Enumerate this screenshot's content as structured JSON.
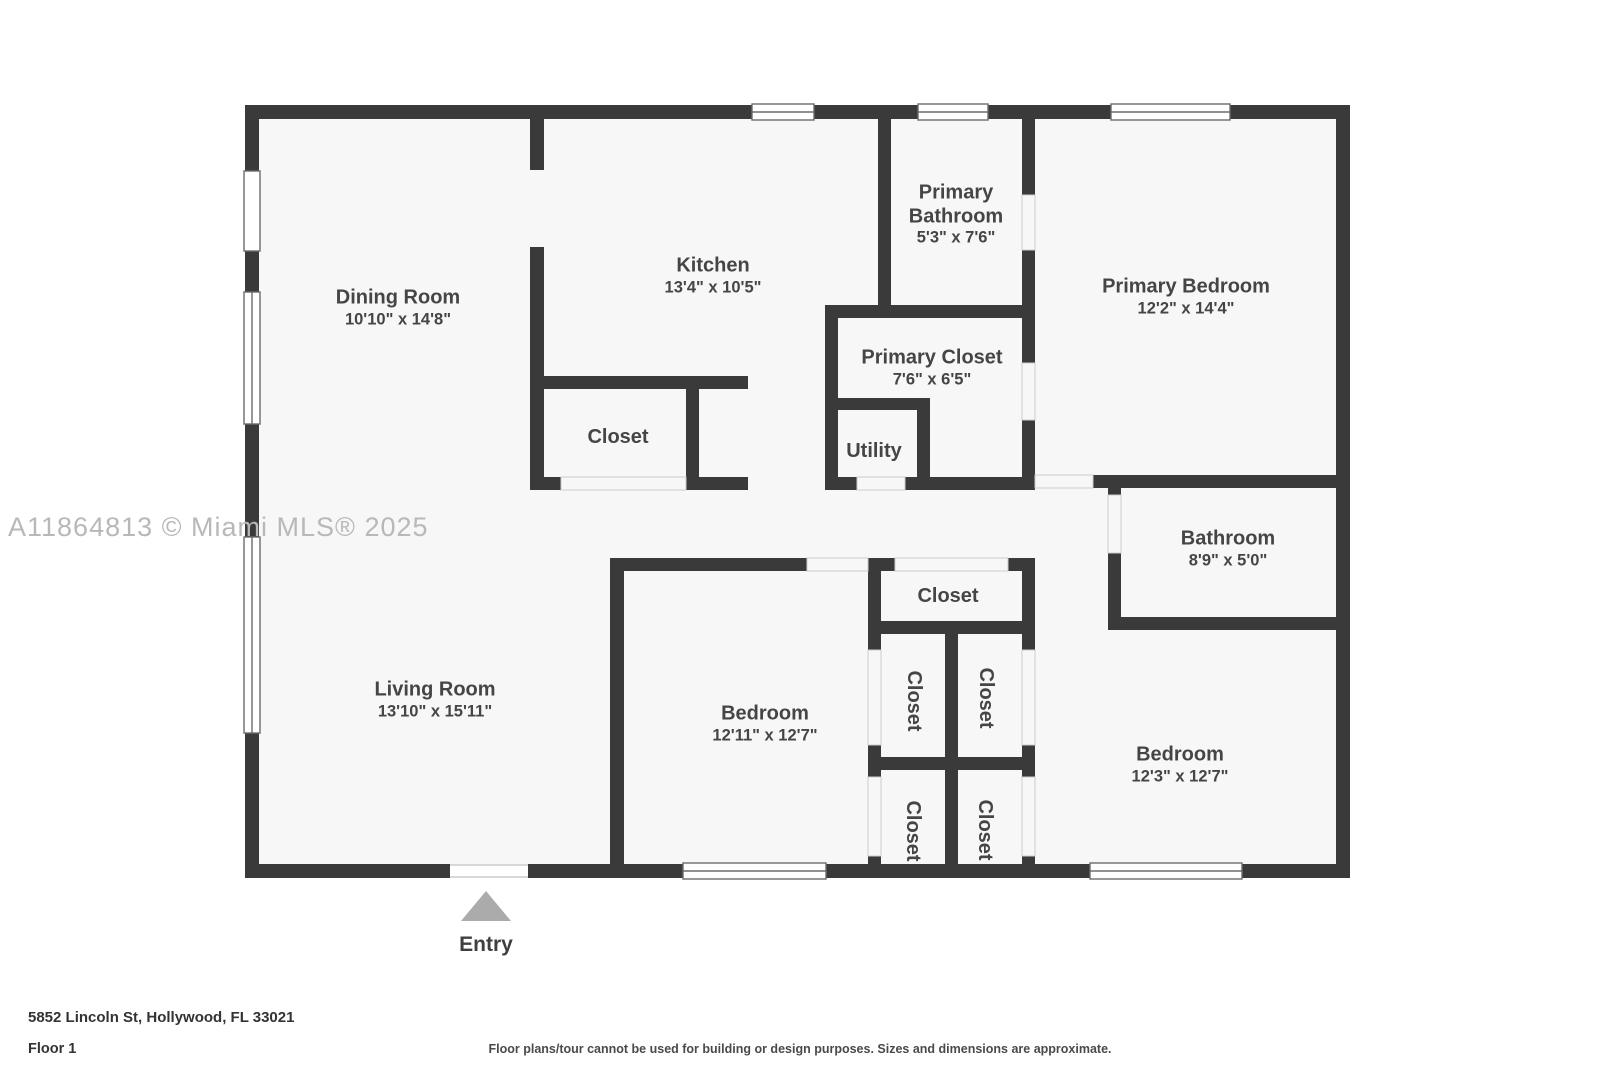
{
  "watermark": "A11864813 © Miami MLS® 2025",
  "entry": {
    "label": "Entry"
  },
  "rooms": {
    "dining": {
      "name": "Dining Room",
      "dims": "10'10\" x 14'8\""
    },
    "kitchen": {
      "name": "Kitchen",
      "dims": "13'4\" x 10'5\""
    },
    "primary_bathroom": {
      "name": "Primary Bathroom",
      "dims": "5'3\" x 7'6\""
    },
    "primary_bedroom": {
      "name": "Primary Bedroom",
      "dims": "12'2\" x 14'4\""
    },
    "primary_closet": {
      "name": "Primary Closet",
      "dims": "7'6\" x 6'5\""
    },
    "utility": {
      "name": "Utility"
    },
    "kitchen_closet": {
      "name": "Closet"
    },
    "living": {
      "name": "Living Room",
      "dims": "13'10\" x 15'11\""
    },
    "bathroom": {
      "name": "Bathroom",
      "dims": "8'9\" x 5'0\""
    },
    "hall_closet": {
      "name": "Closet"
    },
    "bedroom_center": {
      "name": "Bedroom",
      "dims": "12'11\" x 12'7\""
    },
    "bedroom_right": {
      "name": "Bedroom",
      "dims": "12'3\" x 12'7\""
    },
    "closet_nw": {
      "name": "Closet"
    },
    "closet_ne": {
      "name": "Closet"
    },
    "closet_sw": {
      "name": "Closet"
    },
    "closet_se": {
      "name": "Closet"
    }
  },
  "footer": {
    "address": "5852 Lincoln St, Hollywood, FL 33021",
    "floor": "Floor 1",
    "disclaimer": "Floor plans/tour cannot be used for building or design purposes. Sizes and dimensions are approximate."
  },
  "colors": {
    "wall": "#3a3a3a",
    "floor": "#f7f7f7",
    "label_text": "#454545",
    "watermark": "#b8b8b8",
    "entry_arrow": "#ababab"
  }
}
